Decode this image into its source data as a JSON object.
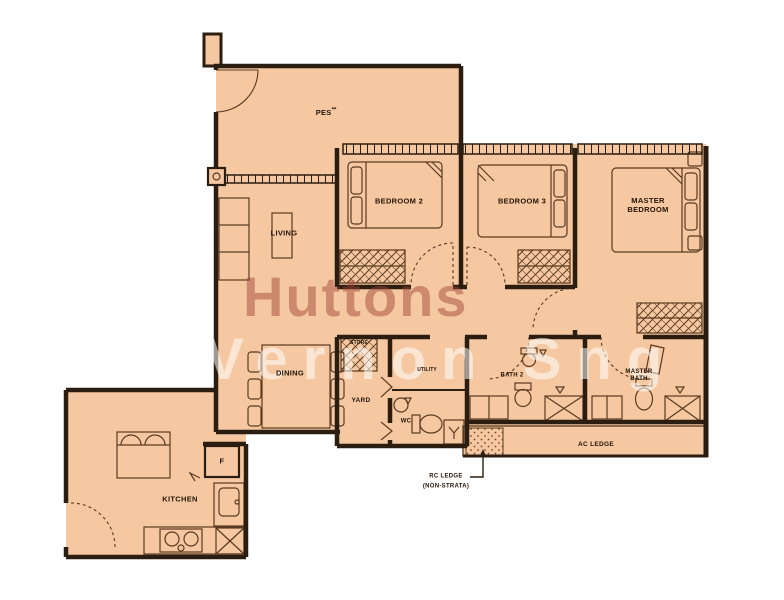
{
  "watermark": {
    "brand": "Huttons",
    "agent": "Vernon Sng"
  },
  "rooms": {
    "pes": "PES",
    "pes_marker": "**",
    "living": "LIVING",
    "dining": "DINING",
    "bedroom2": "BEDROOM 2",
    "bedroom3": "BEDROOM 3",
    "master_bedroom": "MASTER BEDROOM",
    "kitchen": "KITCHEN",
    "fridge": "F",
    "yard": "YARD",
    "store": "STORE",
    "utility": "UTILITY",
    "wc": "WC",
    "bath2": "BATH 2",
    "master_bath": "MASTER BATH",
    "ac_ledge": "AC LEDGE"
  },
  "annotations": {
    "rc_ledge_line1": "RC LEDGE",
    "rc_ledge_line2": "(NON-STRATA)"
  },
  "colors": {
    "floor_fill": "#f5c8a1",
    "wall": "#2b1d10",
    "furniture_line": "#5a3a20",
    "watermark_brand": "#9e4636",
    "watermark_agent": "#ffffff"
  }
}
